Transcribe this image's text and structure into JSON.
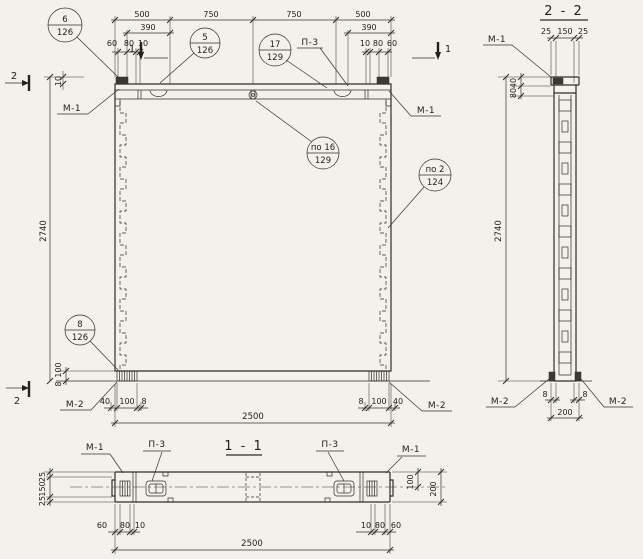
{
  "labels": {
    "m1": "М-1",
    "m2": "М-2",
    "p3": "П-3"
  },
  "markers": {
    "one": "1",
    "two": "2"
  },
  "front": {
    "top_dims": [
      "500",
      "750",
      "750",
      "500"
    ],
    "dim_390_left": "390",
    "dim_390_right": "390",
    "small_left": [
      "60",
      "80",
      "10"
    ],
    "small_right": [
      "10",
      "80",
      "60"
    ],
    "top_offset": "10",
    "height": "2740",
    "width": "2500",
    "pad_left_h": [
      "40",
      "100",
      "8"
    ],
    "pad_left_v": [
      "100",
      "8"
    ],
    "pad_right_h": [
      "8",
      "100",
      "40"
    ],
    "callouts": [
      {
        "num": "6",
        "ref": "126"
      },
      {
        "num": "5",
        "ref": "126"
      },
      {
        "num": "17",
        "ref": "129"
      },
      {
        "num": "по 16",
        "ref": "129"
      },
      {
        "num": "по 2",
        "ref": "124"
      },
      {
        "num": "8",
        "ref": "126"
      }
    ]
  },
  "section22": {
    "title": "2 - 2",
    "top_dims": [
      "25",
      "150",
      "25"
    ],
    "cap_dims": [
      "40",
      "80"
    ],
    "height": "2740",
    "gap_dims": [
      "8",
      "8"
    ],
    "width": "200"
  },
  "section11": {
    "title": "1 - 1",
    "left_dims": [
      "25",
      "150",
      "25"
    ],
    "right_dims": [
      "100",
      "200"
    ],
    "bottom_left": [
      "60",
      "80",
      "10"
    ],
    "bottom_right": [
      "10",
      "80",
      "60"
    ],
    "width": "2500"
  }
}
